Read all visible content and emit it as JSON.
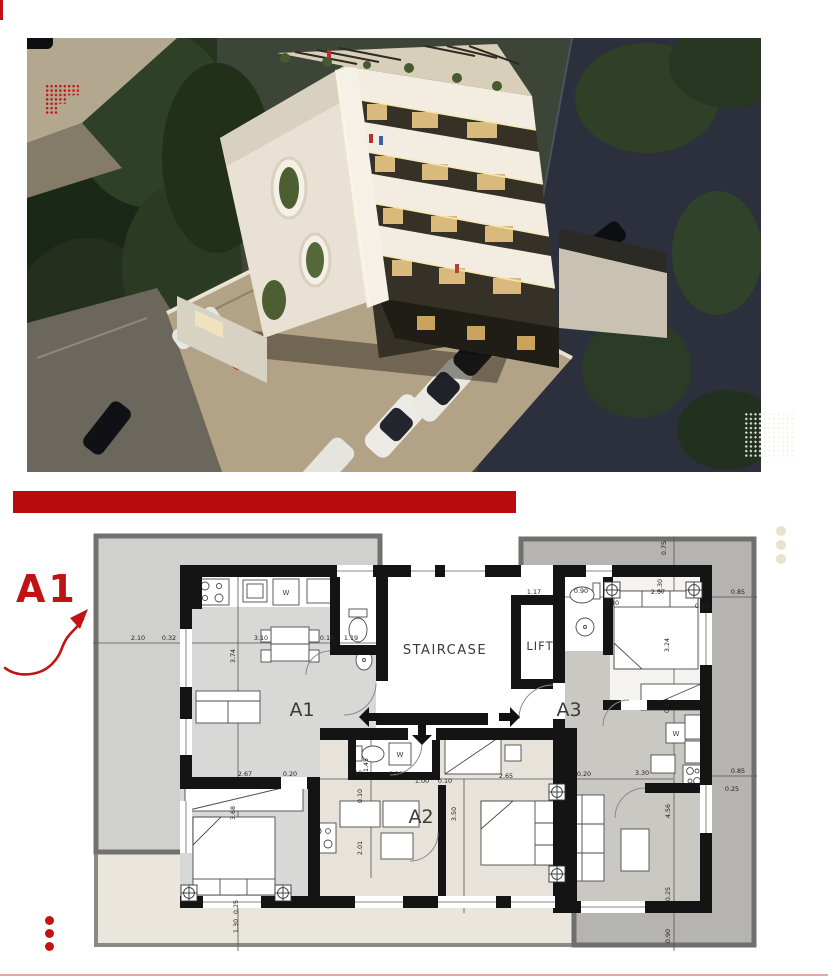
{
  "page": {
    "accent_red": "#c01313",
    "divider_red": "#b90d0d",
    "dot_red": "#c11414",
    "dot_beige": "#e9e1ce",
    "bottom_line_color": "#e2aaa2"
  },
  "callout": {
    "label": "A1"
  },
  "hero": {
    "palette": {
      "building_white": "#f0eadf",
      "floor_band_dark": "#38342a",
      "window_warm": "#d9b97c",
      "tree_green": "#2c3b25",
      "road_dark": "#2b303c",
      "pavement_beige": "#b2a286",
      "umbrella_red": "#a32323"
    }
  },
  "icons": {
    "entry_arrow_left": "arrow-left",
    "entry_arrow_right": "arrow-right",
    "entry_arrow_down": "arrow-down"
  },
  "plan": {
    "rooms": {
      "staircase": "STAIRCASE",
      "lift": "LIFT",
      "a1": "A1",
      "a2": "A2",
      "a3": "A3"
    },
    "washer_label": "W",
    "dims": [
      "2.10",
      "0.32",
      "3.10",
      "0.10",
      "1.19",
      "1.17",
      "0.90",
      "0.10",
      "2.57",
      "0.25",
      "0.85",
      "0.75",
      "2.30",
      "3.24",
      "0.10",
      "3.74",
      "2.67",
      "0.20",
      "2.10",
      "0.10",
      "1.00",
      "0.10",
      "2.65",
      "0.20",
      "3.30",
      "0.85",
      "0.25",
      "1.45",
      "0.10",
      "2.01",
      "3.68",
      "3.50",
      "4.56",
      "0.25",
      "0.90",
      "0.25",
      "1.30"
    ]
  }
}
